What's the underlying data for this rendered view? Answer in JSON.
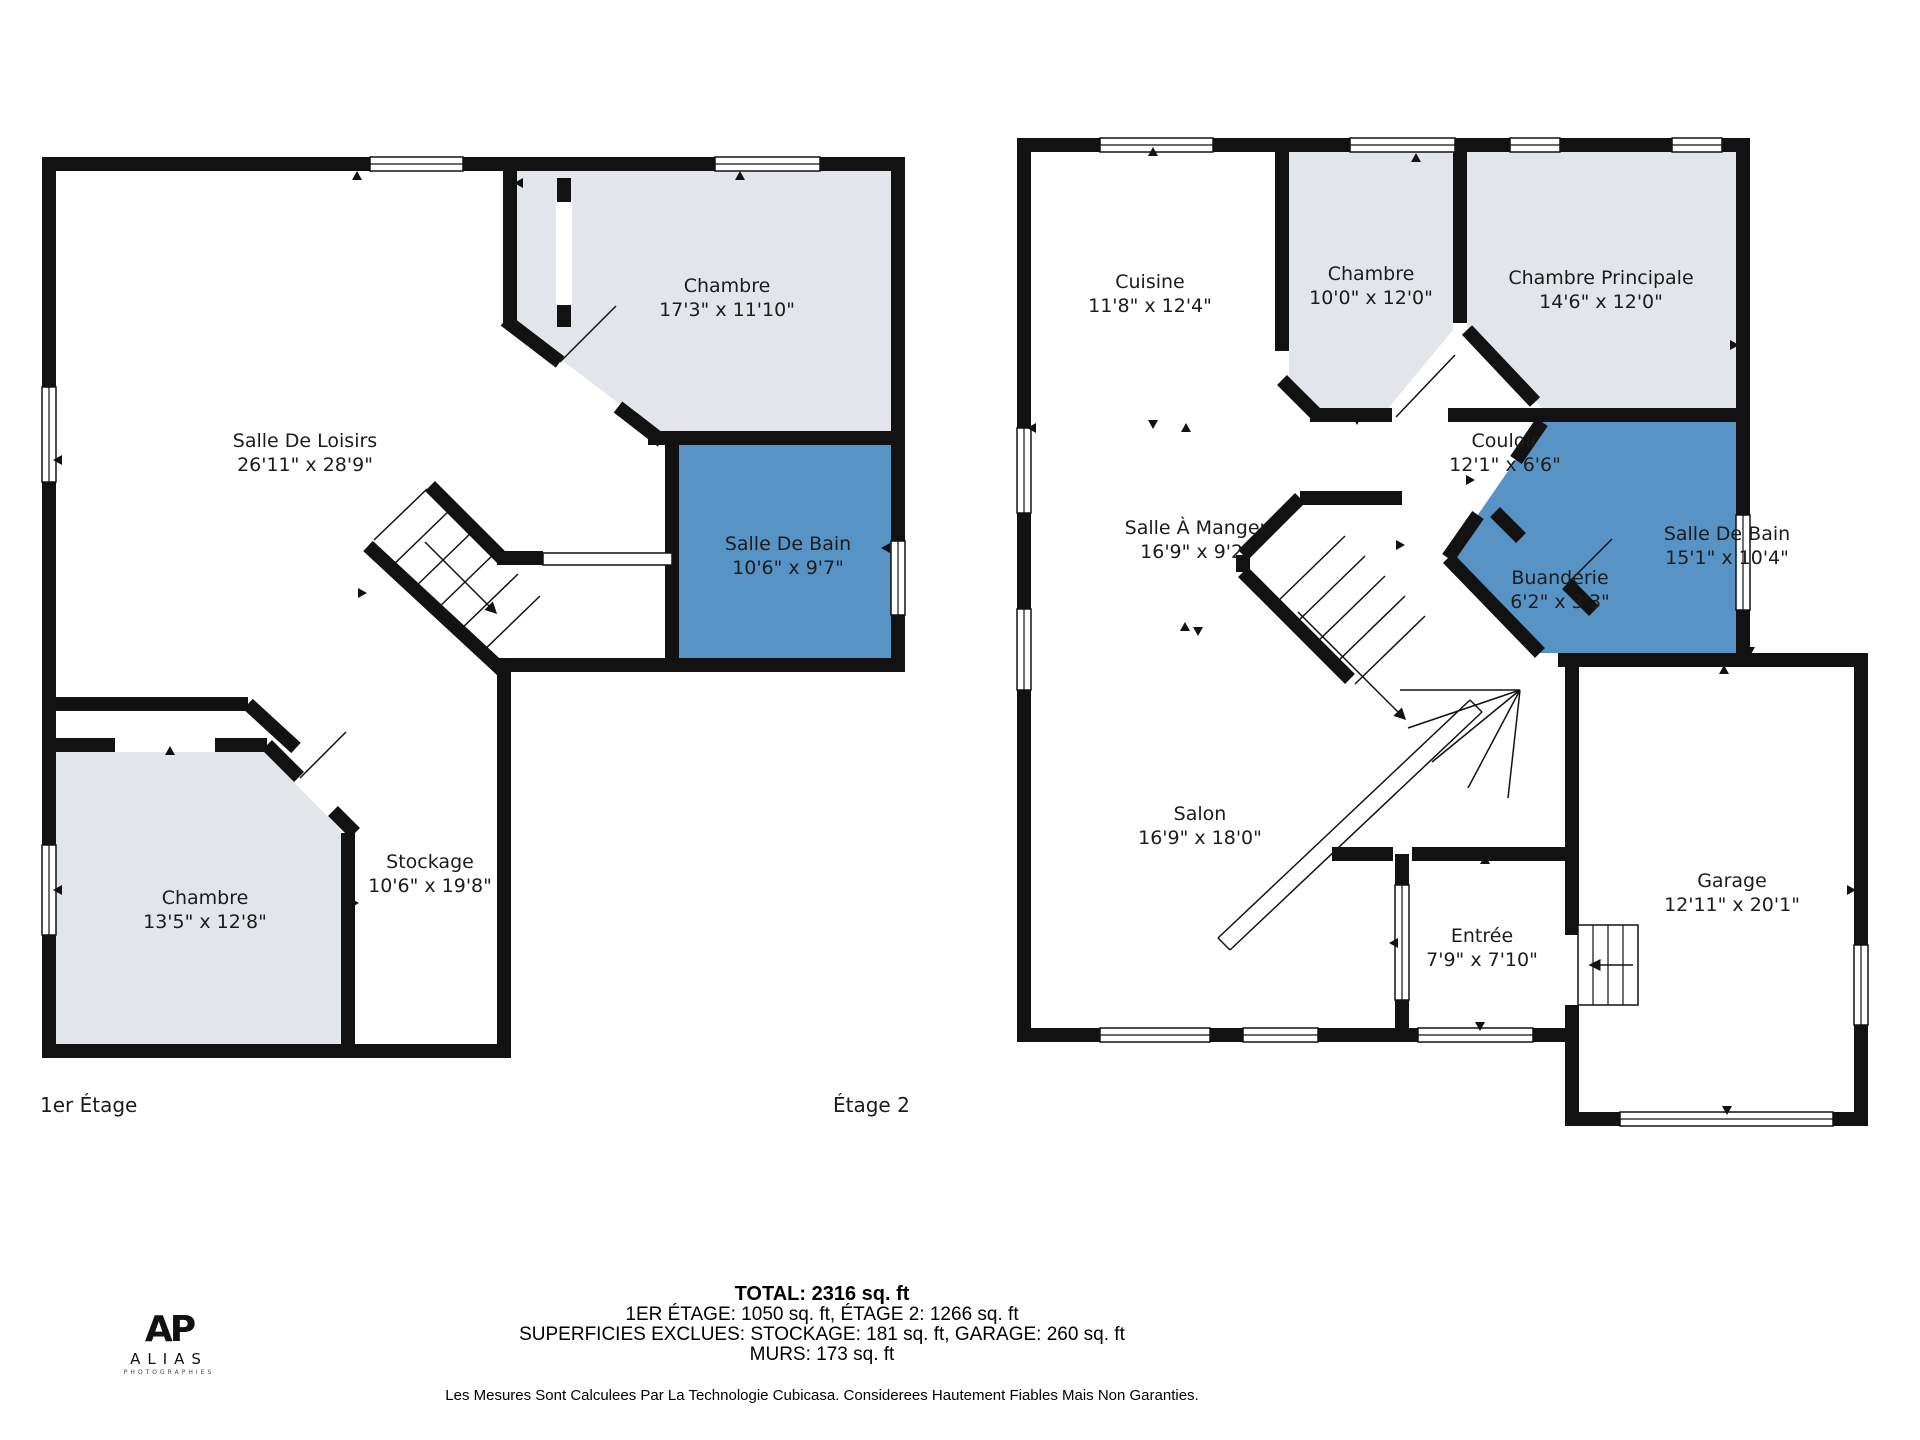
{
  "colors": {
    "wall": "#121212",
    "room_gray": "#e2e5e9",
    "room_blue": "#5793c5",
    "background": "#ffffff",
    "text": "#1c1c1c"
  },
  "floor1": {
    "label": "1er Étage",
    "rooms": [
      {
        "name": "Salle De Loisirs",
        "dims": "26'11\" x 28'9\"",
        "cx": 305,
        "cy": 455
      },
      {
        "name": "Chambre",
        "dims": "17'3\" x 11'10\"",
        "cx": 727,
        "cy": 300
      },
      {
        "name": "Salle De Bain",
        "dims": "10'6\" x 9'7\"",
        "cx": 788,
        "cy": 558
      },
      {
        "name": "Chambre",
        "dims": "13'5\" x 12'8\"",
        "cx": 205,
        "cy": 912
      },
      {
        "name": "Stockage",
        "dims": "10'6\" x 19'8\"",
        "cx": 430,
        "cy": 876
      }
    ]
  },
  "floor2": {
    "label": "Étage 2",
    "rooms": [
      {
        "name": "Cuisine",
        "dims": "11'8\" x 12'4\"",
        "cx": 1150,
        "cy": 296
      },
      {
        "name": "Chambre",
        "dims": "10'0\" x 12'0\"",
        "cx": 1371,
        "cy": 288
      },
      {
        "name": "Chambre Principale",
        "dims": "14'6\" x 12'0\"",
        "cx": 1601,
        "cy": 292
      },
      {
        "name": "Couloir",
        "dims": "12'1\" x 6'6\"",
        "cx": 1505,
        "cy": 455
      },
      {
        "name": "Salle À Manger",
        "dims": "16'9\" x 9'2\"",
        "cx": 1196,
        "cy": 542
      },
      {
        "name": "Salle De Bain",
        "dims": "15'1\" x 10'4\"",
        "cx": 1727,
        "cy": 548
      },
      {
        "name": "Buanderie",
        "dims": "6'2\" x 3'3\"",
        "cx": 1560,
        "cy": 592
      },
      {
        "name": "Salon",
        "dims": "16'9\" x 18'0\"",
        "cx": 1200,
        "cy": 828
      },
      {
        "name": "Entrée",
        "dims": "7'9\" x 7'10\"",
        "cx": 1482,
        "cy": 950
      },
      {
        "name": "Garage",
        "dims": "12'11\" x 20'1\"",
        "cx": 1732,
        "cy": 895
      }
    ]
  },
  "summary": {
    "total": "TOTAL: 2316 sq. ft",
    "line2": "1ER ÉTAGE: 1050 sq. ft, ÉTAGE 2: 1266 sq. ft",
    "line3": "SUPERFICIES EXCLUES: STOCKAGE: 181 sq. ft, GARAGE: 260 sq. ft",
    "line4": "MURS: 173 sq. ft",
    "disclaimer": "Les Mesures Sont Calculees Par La Technologie Cubicasa. Considerees Hautement Fiables Mais Non Garanties."
  },
  "logo": {
    "monogram": "AP",
    "name": "ALIAS",
    "sub": "PHOTOGRAPHIES"
  }
}
